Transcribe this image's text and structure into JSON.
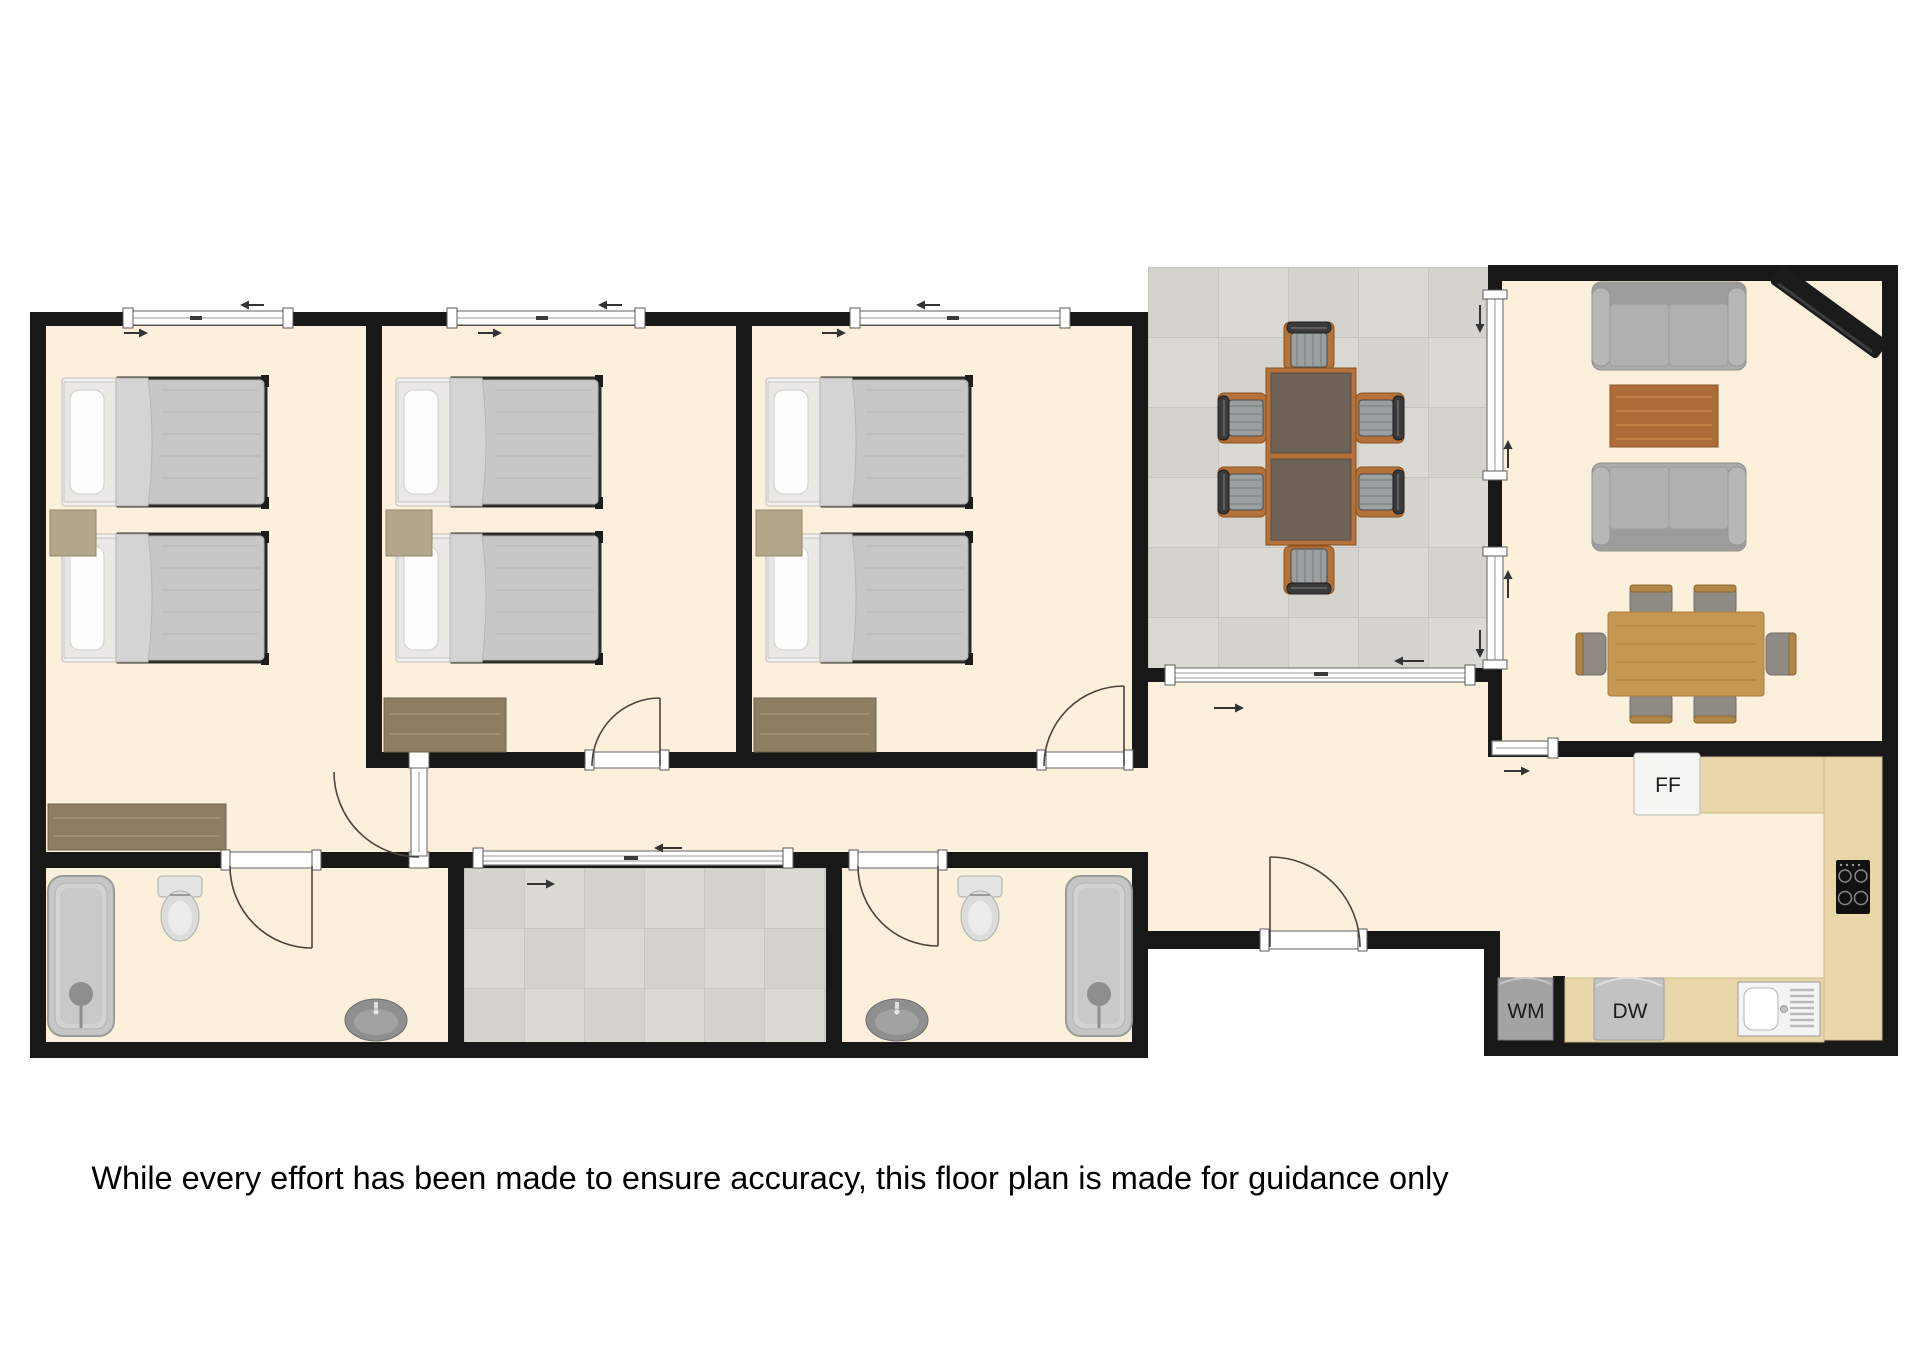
{
  "disclaimer": "While every effort has been made to ensure accuracy, this floor plan is made for guidance only",
  "appliances": {
    "fridge_freezer": "FF",
    "washing_machine": "WM",
    "dishwasher": "DW"
  },
  "colors": {
    "wall": "#181818",
    "floor": "#faf0dc",
    "tileBase": "#dbd9d4",
    "tileAlt": "#cfcdc8",
    "tileLine": "#c1bfba",
    "counter": "#e9d7a9",
    "woodTable": "#c59752",
    "coffeeTable": "#b06c38",
    "terraceTable": "#6e6156",
    "terraceFrame": "#b5713a",
    "sofa": "#ababab"
  }
}
